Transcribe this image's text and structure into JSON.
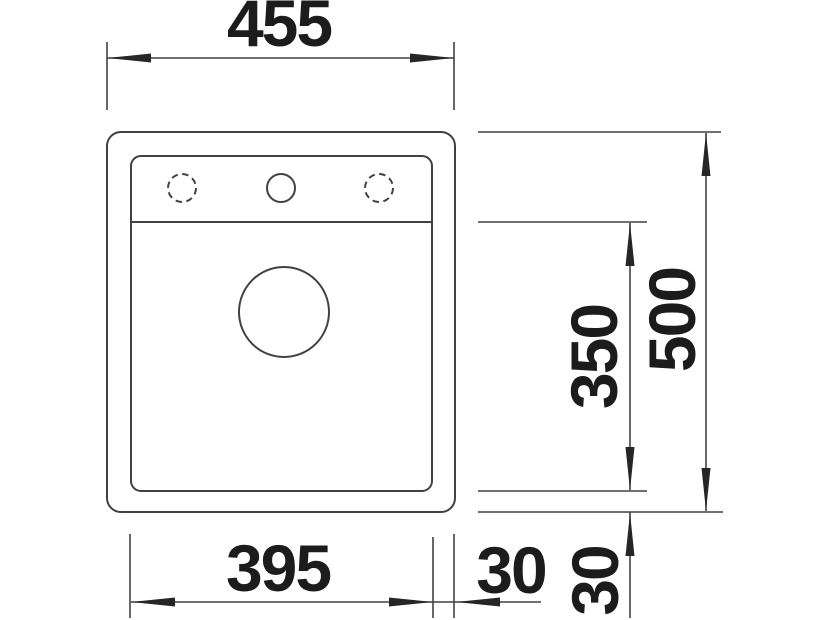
{
  "page": {
    "description": "Technical dimension drawing, top view of a single-bowl inset sink with three tap holes and drain"
  },
  "colors": {
    "background": "#ffffff",
    "object_line": "#414141",
    "dimension_line": "#414141",
    "arrowhead": "#262626",
    "label_text": "#1c1c1c"
  },
  "dimensions": {
    "overall_width_mm": "455",
    "overall_depth_mm": "500",
    "bowl_depth_mm": "350",
    "bowl_width_mm": "395",
    "right_edge_offset_mm": "30",
    "bottom_edge_offset_mm": "30"
  }
}
